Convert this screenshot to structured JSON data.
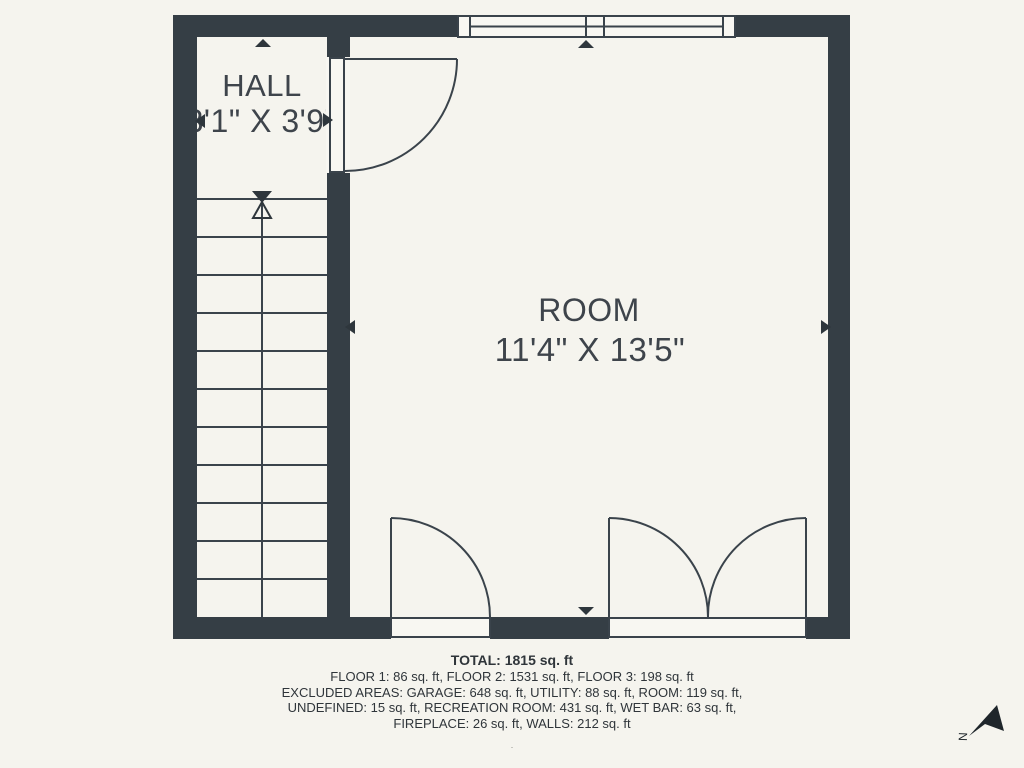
{
  "plan": {
    "hall": {
      "name": "HALL",
      "dims": "3'1\" X 3'9\""
    },
    "room": {
      "name": "ROOM",
      "dims": "11'4\" X 13'5\""
    }
  },
  "summary": {
    "total": "TOTAL: 1815 sq. ft",
    "lines": [
      "FLOOR 1: 86 sq. ft, FLOOR 2: 1531 sq. ft, FLOOR 3: 198 sq. ft",
      "EXCLUDED AREAS: GARAGE: 648 sq. ft, UTILITY: 88 sq. ft, ROOM: 119 sq. ft,",
      "UNDEFINED: 15 sq. ft, RECREATION ROOM: 431 sq. ft, WET BAR: 63 sq. ft,",
      "FIREPLACE: 26 sq. ft, WALLS: 212 sq. ft"
    ],
    "footnote": "."
  },
  "compass": {
    "label": "N"
  },
  "colors": {
    "wall": "#353e45",
    "line": "#3a434b",
    "marker": "#2e363c",
    "background": "#f5f4ee",
    "interior": "#f8f7f2",
    "label_text": "#3e444b",
    "summary_text": "#2f353a"
  }
}
